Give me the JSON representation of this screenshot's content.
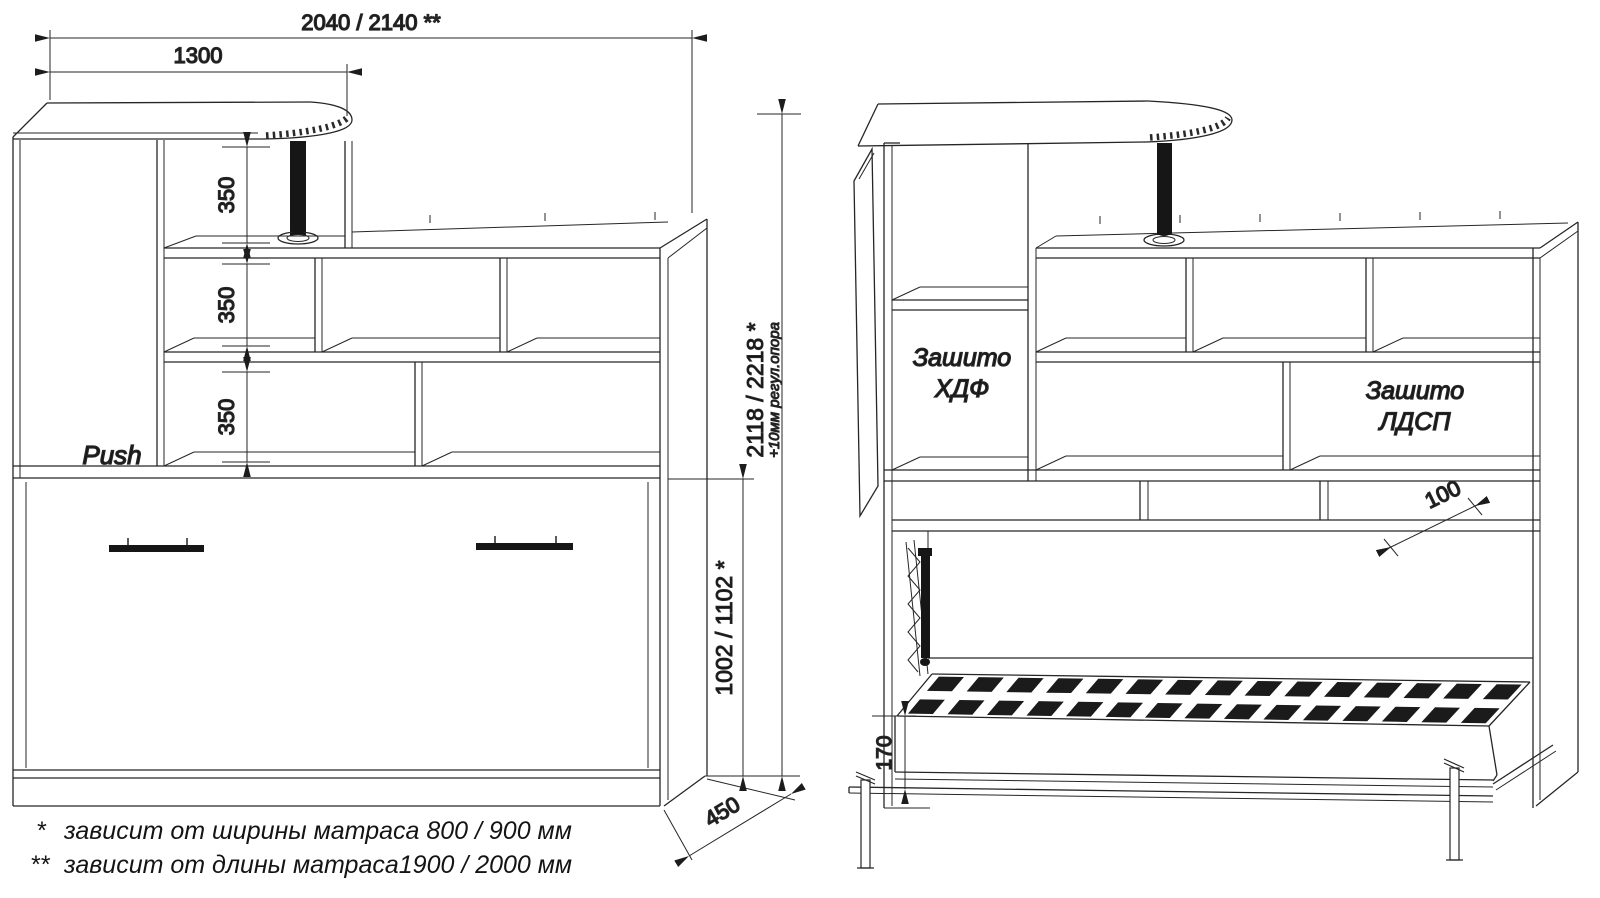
{
  "drawing": {
    "background": "#ffffff",
    "line_color": "#262626"
  },
  "closed_view": {
    "dim_total_width": "2040 / 2140 **",
    "dim_desk_width": "1300",
    "shelf_spacings": [
      "350",
      "350",
      "350"
    ],
    "door_label": "Push",
    "dim_depth": "450"
  },
  "height_dims": {
    "dim_total_height": "2118 / 2218 *",
    "support_note": "+10мм регул.опора",
    "dim_bed_section_height": "1002 / 1102 *"
  },
  "open_view": {
    "hdf_panel_line1": "Зашито",
    "hdf_panel_line2": "ХДФ",
    "ldsp_panel_line1": "Зашито",
    "ldsp_panel_line2": "ЛДСП",
    "dim_niche_depth": "100",
    "dim_bed_frame_height": "170"
  },
  "footnotes": [
    {
      "marker": "*",
      "text": "зависит от ширины матраса 800 / 900 мм"
    },
    {
      "marker": "**",
      "text": "зависит от длины матраса1900 / 2000 мм"
    }
  ]
}
